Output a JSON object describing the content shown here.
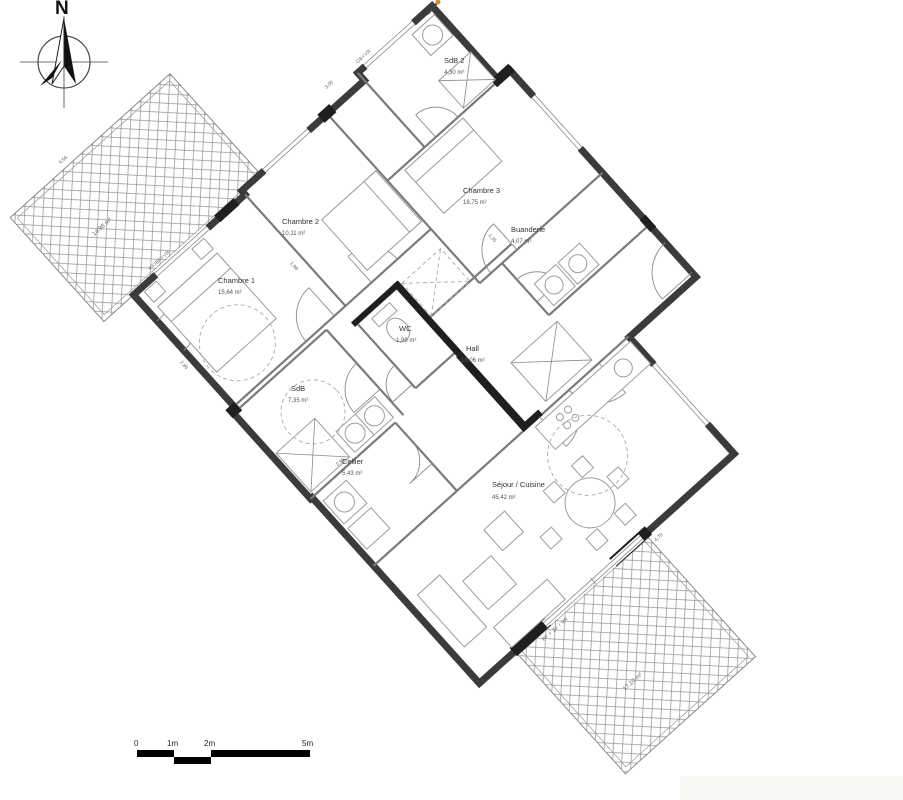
{
  "compass": {
    "north_label": "N"
  },
  "rooms": [
    {
      "name": "Chambre 1",
      "area": "15,64 m²"
    },
    {
      "name": "Chambre 2",
      "area": "10,11 m²"
    },
    {
      "name": "Chambre 3",
      "area": "18,75 m²"
    },
    {
      "name": "SdB 2",
      "area": "4,30 m²"
    },
    {
      "name": "Buanderie",
      "area": "4,07 m²"
    },
    {
      "name": "WC",
      "area": "1,99 m²"
    },
    {
      "name": "Hall",
      "area": "18,06 m²"
    },
    {
      "name": "SdB",
      "area": "7,35 m²"
    },
    {
      "name": "Cellier",
      "area": "5,43 m²"
    },
    {
      "name": "Séjour / Cuisine",
      "area": "45,42 m²"
    }
  ],
  "terraces": [
    {
      "area": "14,98 m²"
    },
    {
      "area": "17,10 m²"
    }
  ],
  "wall_labels": {
    "w1": "PF/BF+VR",
    "w2": "OB+VR",
    "w3": "PF + ZF / VR"
  },
  "dimensions": {
    "d1": "4,56",
    "d2": "3,05",
    "d3": "1,98",
    "d4": "1,35",
    "d5": "2,95",
    "d6": "4,78",
    "d7": "2,80"
  },
  "scale_bar": {
    "t0": "0",
    "t1": "1m",
    "t2": "2m",
    "t3": "5m"
  },
  "colors": {
    "wall": "#3b3b3b",
    "accent_dot": "#d78e2e"
  }
}
